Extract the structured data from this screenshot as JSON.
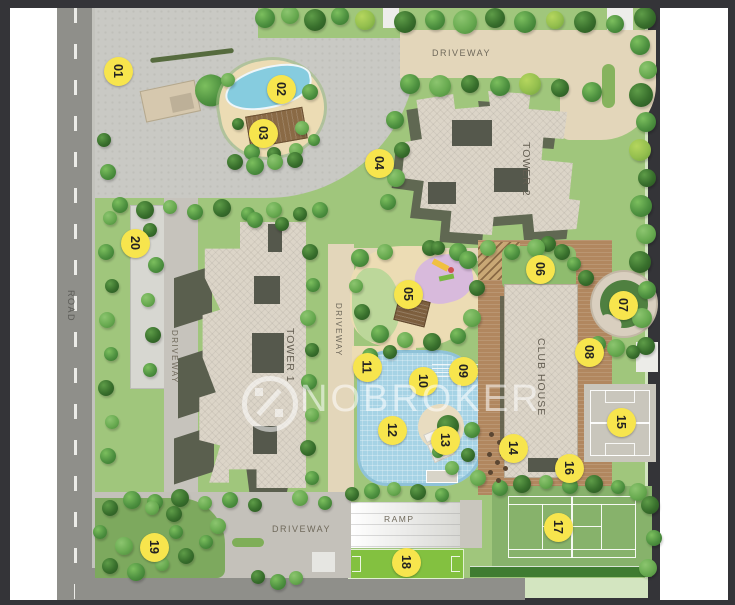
{
  "plan": {
    "title": "Residential site plan",
    "watermark": {
      "brand": "NOBROKER",
      "logo": "no-brokerage-percent-icon"
    },
    "labels": {
      "road": "ROAD",
      "driveway": "DRIVEWAY",
      "ramp": "RAMP",
      "tower1": "TOWER 1",
      "tower2": "TOWER 2",
      "clubhouse": "CLUB HOUSE"
    },
    "markers": [
      {
        "num": "01",
        "x": 118,
        "y": 71
      },
      {
        "num": "02",
        "x": 281,
        "y": 89
      },
      {
        "num": "03",
        "x": 263,
        "y": 133
      },
      {
        "num": "04",
        "x": 379,
        "y": 163
      },
      {
        "num": "05",
        "x": 408,
        "y": 294
      },
      {
        "num": "06",
        "x": 540,
        "y": 269
      },
      {
        "num": "07",
        "x": 623,
        "y": 305
      },
      {
        "num": "08",
        "x": 589,
        "y": 352
      },
      {
        "num": "09",
        "x": 463,
        "y": 371
      },
      {
        "num": "10",
        "x": 423,
        "y": 381
      },
      {
        "num": "11",
        "x": 367,
        "y": 367
      },
      {
        "num": "12",
        "x": 392,
        "y": 430
      },
      {
        "num": "13",
        "x": 445,
        "y": 440
      },
      {
        "num": "14",
        "x": 513,
        "y": 448
      },
      {
        "num": "15",
        "x": 621,
        "y": 422
      },
      {
        "num": "16",
        "x": 569,
        "y": 468
      },
      {
        "num": "17",
        "x": 558,
        "y": 527
      },
      {
        "num": "18",
        "x": 406,
        "y": 562
      },
      {
        "num": "19",
        "x": 154,
        "y": 547
      },
      {
        "num": "20",
        "x": 135,
        "y": 243
      }
    ],
    "colors": {
      "marker_yellow": "#f7e54d",
      "lawn_green": "#a0c67c",
      "pale_walk": "#d3e5c0",
      "pool_blue": "#a6d3e5",
      "deck_wood": "#b1875f",
      "building_beige": "#dcd5c8",
      "building_shadow": "#5a5f4e",
      "road_gray": "#8f8f8a",
      "tennis_green": "#87b26b",
      "sport_court_gray": "#c9c6bc",
      "play_lawn_bright": "#83c140",
      "frame_dark": "#343438"
    }
  }
}
